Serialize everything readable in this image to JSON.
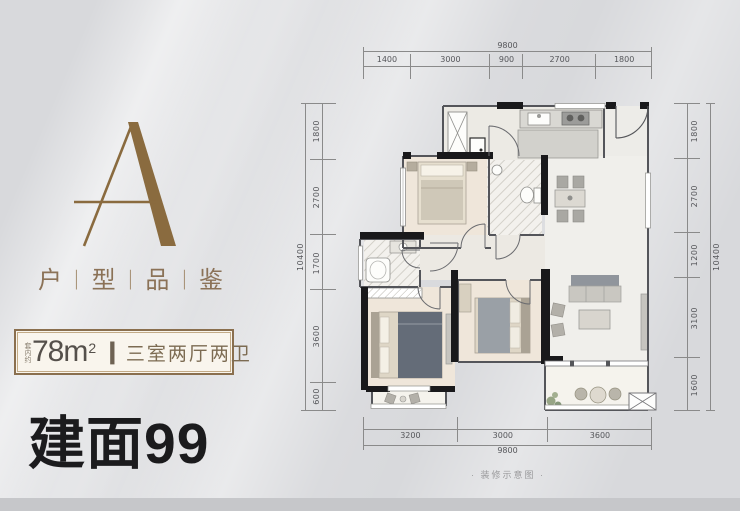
{
  "panel": {
    "logo_letter": "A",
    "series": {
      "chars": [
        "户",
        "型",
        "品",
        "鉴"
      ],
      "divider": "|"
    },
    "area_box": {
      "prefix": "套内约",
      "area": "78m",
      "area_sup": "2",
      "divider": "|",
      "layout_text": "三室两厅两卫"
    },
    "headline": "建面99"
  },
  "plan": {
    "caption": "· 装修示意图 ·",
    "dims": {
      "top": {
        "overall": "9800",
        "segments": [
          "1400",
          "3000",
          "900",
          "2700",
          "1800"
        ]
      },
      "bottom": {
        "overall": "9800",
        "segments": [
          "3200",
          "3000",
          "3600"
        ]
      },
      "left": {
        "overall": "10400",
        "segments": [
          "1800",
          "2700",
          "1700",
          "3600",
          "600"
        ]
      },
      "right": {
        "overall": "10400",
        "segments": [
          "1800",
          "2700",
          "1200",
          "3100",
          "1600"
        ]
      }
    }
  },
  "colors": {
    "gold": "#8a6b3f",
    "brown": "#8b7257",
    "cream": "#f9f5ed",
    "wall_black": "#19191b",
    "headline_black": "#1b1b1d"
  }
}
